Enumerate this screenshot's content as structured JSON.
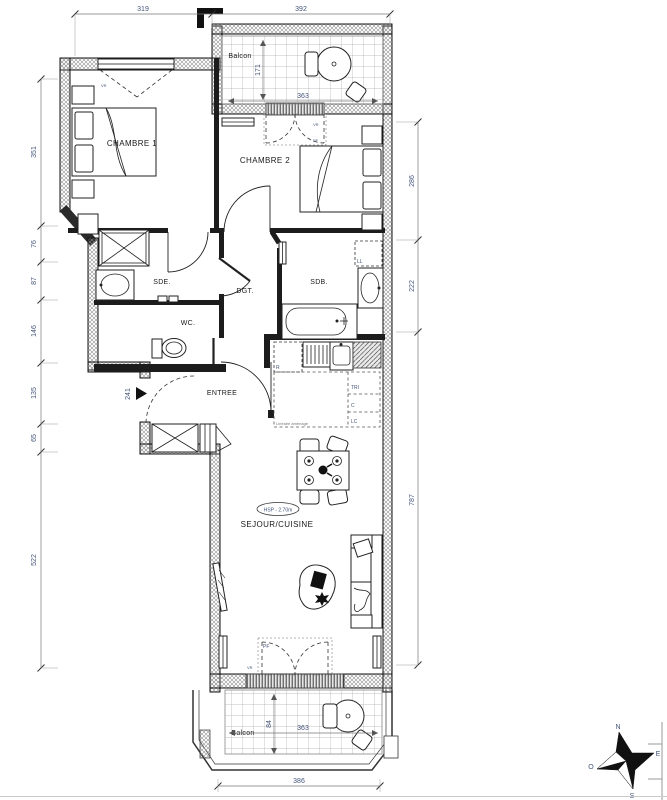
{
  "colors": {
    "wall": "#1c1c1c",
    "dimension_text": "#44557a",
    "background": "#ffffff"
  },
  "plan": {
    "rooms": {
      "chambre1": "CHAMBRE 1",
      "chambre2": "CHAMBRE 2",
      "sde": "SDE.",
      "wc": "WC.",
      "dgt": "DGT.",
      "sdb": "SDB.",
      "entree": "ENTREE",
      "sejour_cuisine": "SEJOUR/CUISINE",
      "balcon_top": "Balcon",
      "balcon_bottom": "Balcon"
    },
    "ceiling_note": "HSP - 2.70m",
    "kitchen": {
      "fridge": "R",
      "tri": "TRI",
      "c": "C",
      "lc": "LC",
      "note": "Linéaire aménagé"
    },
    "appliances": {
      "washer": "LL"
    },
    "openings": {
      "pf": "PF",
      "vr": "VR"
    },
    "dimensions": {
      "top": [
        "319",
        "392"
      ],
      "left": [
        "351",
        "76",
        "87",
        "146",
        "135",
        "65",
        "522"
      ],
      "right": [
        "286",
        "222",
        "787"
      ],
      "balcony_top": {
        "depth": "171",
        "width": "363"
      },
      "balcony_bottom": {
        "width": "363",
        "depth": "84",
        "outer": "386"
      },
      "entry_door": "241"
    },
    "compass": {
      "n": "N",
      "e": "E",
      "s": "S",
      "o": "O"
    }
  }
}
